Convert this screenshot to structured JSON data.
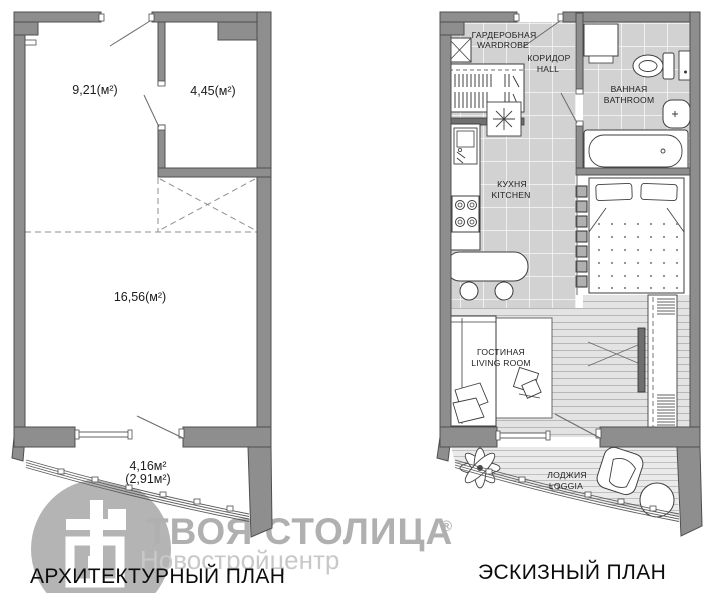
{
  "plans": {
    "architectural": {
      "caption": "АРХИТЕКТУРНЫЙ ПЛАН",
      "areas": {
        "top_left_room": "9,21(м²)",
        "top_right_room": "4,45(м²)",
        "main_room": "16,56(м²)",
        "loggia_full": "4,16м²",
        "loggia_coeff": "(2,91м²)"
      }
    },
    "sketch": {
      "caption": "ЭСКИЗНЫЙ ПЛАН",
      "rooms": {
        "wardrobe": {
          "ru": "ГАРДЕРОБНАЯ",
          "en": "WARDROBE"
        },
        "hall": {
          "ru": "КОРИДОР",
          "en": "HALL"
        },
        "bathroom": {
          "ru": "ВАННАЯ",
          "en": "BATHROOM"
        },
        "kitchen": {
          "ru": "КУХНЯ",
          "en": "KITCHEN"
        },
        "living_room": {
          "ru": "ГОСТИНАЯ",
          "en": "LIVING ROOM"
        },
        "loggia": {
          "ru": "ЛОДЖИЯ",
          "en": "LOGGIA"
        }
      }
    }
  },
  "watermark": {
    "brand": "ТВОЯ СТОЛИЦА",
    "registered": "®",
    "subtitle": "Новостройцентр"
  },
  "colors": {
    "wall": "#8e8e8e",
    "wall_outline": "#4f4f4f",
    "tile_floor": "#d2d2d2",
    "plank_floor": "#e3e3e3",
    "loggia_floor": "#eaeaea",
    "watermark_gray": "#b3b3b3",
    "label_text": "#222222"
  }
}
